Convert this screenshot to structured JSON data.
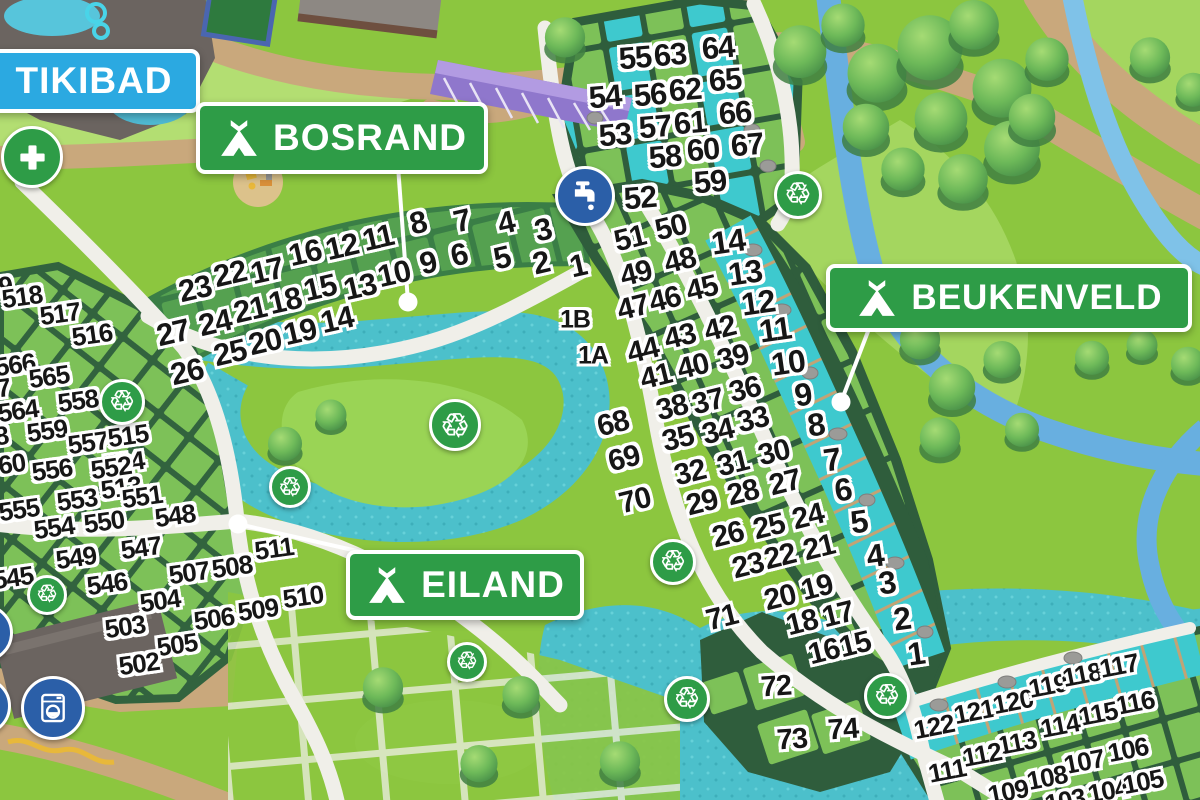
{
  "map": {
    "recycle_glyph": "♲",
    "colors": {
      "banner_green": "#2E9C47",
      "banner_blue": "#2BA9E1",
      "icon_blue": "#2B5FA8",
      "water_teal": "#4CC0CB",
      "stream_blue": "#68AFE0",
      "number_fill": "#161616",
      "number_outline": "#FFFFFF"
    },
    "banners": {
      "tikibad": {
        "label": "TIKIBAD"
      },
      "bosrand": {
        "label": "BOSRAND"
      },
      "beukenveld": {
        "label": "BEUKENVELD"
      },
      "eiland": {
        "label": "EILAND"
      }
    },
    "area_styles": {
      "A": {
        "size": 31,
        "rot": -5
      },
      "B": {
        "size": 30,
        "rot": -14
      },
      "C": {
        "size": 31,
        "rot": -13
      },
      "D": {
        "size": 32,
        "rot": -8
      },
      "E": {
        "size": 26,
        "rot": -8
      },
      "F": {
        "size": 26,
        "rot": -11
      },
      "G": {
        "size": 29,
        "rot": -4
      },
      "H": {
        "size": 25,
        "rot": 0
      }
    },
    "plot_labels": [
      [
        "55",
        635,
        58,
        "A"
      ],
      [
        "63",
        670,
        55,
        "A"
      ],
      [
        "64",
        718,
        48,
        "A"
      ],
      [
        "54",
        605,
        97,
        "A"
      ],
      [
        "56",
        650,
        95,
        "A"
      ],
      [
        "62",
        685,
        90,
        "A"
      ],
      [
        "65",
        725,
        80,
        "A"
      ],
      [
        "53",
        615,
        135,
        "A"
      ],
      [
        "57",
        655,
        127,
        "A"
      ],
      [
        "61",
        690,
        123,
        "A"
      ],
      [
        "66",
        735,
        113,
        "A"
      ],
      [
        "58",
        665,
        157,
        "A"
      ],
      [
        "60",
        703,
        150,
        "A"
      ],
      [
        "67",
        747,
        145,
        "A"
      ],
      [
        "59",
        710,
        182,
        "A"
      ],
      [
        "52",
        640,
        198,
        "A"
      ],
      [
        "51",
        630,
        239,
        "B"
      ],
      [
        "50",
        671,
        228,
        "B"
      ],
      [
        "49",
        636,
        274,
        "B"
      ],
      [
        "48",
        680,
        261,
        "B"
      ],
      [
        "47",
        633,
        308,
        "B"
      ],
      [
        "46",
        665,
        300,
        "B"
      ],
      [
        "45",
        702,
        289,
        "B"
      ],
      [
        "44",
        643,
        351,
        "B"
      ],
      [
        "43",
        680,
        337,
        "B"
      ],
      [
        "42",
        720,
        329,
        "B"
      ],
      [
        "41",
        656,
        377,
        "B"
      ],
      [
        "40",
        693,
        367,
        "B"
      ],
      [
        "39",
        733,
        358,
        "B"
      ],
      [
        "38",
        672,
        408,
        "B"
      ],
      [
        "37",
        708,
        402,
        "B"
      ],
      [
        "36",
        745,
        390,
        "B"
      ],
      [
        "35",
        678,
        439,
        "B"
      ],
      [
        "34",
        718,
        432,
        "B"
      ],
      [
        "33",
        753,
        420,
        "B"
      ],
      [
        "32",
        690,
        473,
        "B"
      ],
      [
        "31",
        733,
        464,
        "B"
      ],
      [
        "30",
        774,
        453,
        "B"
      ],
      [
        "29",
        702,
        503,
        "B"
      ],
      [
        "28",
        743,
        493,
        "B"
      ],
      [
        "27",
        785,
        483,
        "B"
      ],
      [
        "26",
        728,
        535,
        "B"
      ],
      [
        "25",
        769,
        527,
        "B"
      ],
      [
        "24",
        808,
        517,
        "B"
      ],
      [
        "23",
        748,
        566,
        "B"
      ],
      [
        "22",
        780,
        557,
        "B"
      ],
      [
        "21",
        819,
        548,
        "B"
      ],
      [
        "20",
        780,
        598,
        "B"
      ],
      [
        "19",
        817,
        588,
        "B"
      ],
      [
        "18",
        802,
        623,
        "B"
      ],
      [
        "17",
        838,
        615,
        "B"
      ],
      [
        "16",
        824,
        652,
        "B"
      ],
      [
        "15",
        855,
        645,
        "B"
      ],
      [
        "68",
        613,
        424,
        "B"
      ],
      [
        "69",
        624,
        459,
        "B"
      ],
      [
        "70",
        635,
        501,
        "B"
      ],
      [
        "71",
        722,
        618,
        "B"
      ],
      [
        "23",
        195,
        289,
        "C"
      ],
      [
        "22",
        230,
        274,
        "C"
      ],
      [
        "17",
        267,
        271,
        "C"
      ],
      [
        "16",
        305,
        253,
        "C"
      ],
      [
        "12",
        342,
        247,
        "C"
      ],
      [
        "11",
        378,
        238,
        "C"
      ],
      [
        "8",
        418,
        223,
        "C"
      ],
      [
        "7",
        462,
        221,
        "C"
      ],
      [
        "4",
        506,
        223,
        "C"
      ],
      [
        "3",
        543,
        230,
        "C"
      ],
      [
        "24",
        215,
        323,
        "C"
      ],
      [
        "21",
        250,
        310,
        "C"
      ],
      [
        "18",
        285,
        301,
        "C"
      ],
      [
        "15",
        320,
        288,
        "C"
      ],
      [
        "13",
        360,
        287,
        "C"
      ],
      [
        "10",
        394,
        274,
        "C"
      ],
      [
        "9",
        428,
        263,
        "C"
      ],
      [
        "6",
        459,
        255,
        "C"
      ],
      [
        "5",
        502,
        258,
        "C"
      ],
      [
        "2",
        541,
        263,
        "C"
      ],
      [
        "1",
        578,
        266,
        "C"
      ],
      [
        "27",
        173,
        333,
        "C"
      ],
      [
        "25",
        230,
        353,
        "C"
      ],
      [
        "20",
        265,
        342,
        "C"
      ],
      [
        "19",
        300,
        332,
        "C"
      ],
      [
        "14",
        337,
        320,
        "C"
      ],
      [
        "26",
        187,
        372,
        "C"
      ],
      [
        "14",
        728,
        242,
        "D"
      ],
      [
        "13",
        745,
        273,
        "D"
      ],
      [
        "12",
        758,
        303,
        "D"
      ],
      [
        "11",
        775,
        330,
        "D"
      ],
      [
        "10",
        788,
        363,
        "D"
      ],
      [
        "9",
        803,
        395,
        "D"
      ],
      [
        "8",
        816,
        425,
        "D"
      ],
      [
        "7",
        832,
        460,
        "D"
      ],
      [
        "6",
        843,
        490,
        "D"
      ],
      [
        "5",
        859,
        522,
        "D"
      ],
      [
        "4",
        875,
        556,
        "D"
      ],
      [
        "3",
        887,
        583,
        "D"
      ],
      [
        "2",
        902,
        619,
        "D"
      ],
      [
        "1",
        916,
        654,
        "D"
      ],
      [
        "72",
        776,
        687,
        "G"
      ],
      [
        "73",
        792,
        740,
        "G"
      ],
      [
        "74",
        843,
        730,
        "G"
      ],
      [
        "1B",
        575,
        320,
        "H"
      ],
      [
        "1A",
        593,
        356,
        "H"
      ],
      [
        "519",
        -8,
        288,
        "E"
      ],
      [
        "518",
        22,
        297,
        "E"
      ],
      [
        "517",
        60,
        314,
        "E"
      ],
      [
        "516",
        92,
        335,
        "E"
      ],
      [
        "566",
        15,
        365,
        "E"
      ],
      [
        "565",
        49,
        377,
        "E"
      ],
      [
        "558",
        78,
        401,
        "E"
      ],
      [
        "567",
        -10,
        390,
        "E"
      ],
      [
        "564",
        18,
        411,
        "E"
      ],
      [
        "559",
        47,
        431,
        "E"
      ],
      [
        "557",
        88,
        443,
        "E"
      ],
      [
        "515",
        128,
        436,
        "E"
      ],
      [
        "514",
        124,
        463,
        "E"
      ],
      [
        "513",
        121,
        488,
        "E"
      ],
      [
        "568",
        -12,
        438,
        "E"
      ],
      [
        "560",
        5,
        465,
        "E"
      ],
      [
        "556",
        52,
        470,
        "E"
      ],
      [
        "552",
        111,
        468,
        "E"
      ],
      [
        "555",
        19,
        510,
        "E"
      ],
      [
        "553",
        77,
        500,
        "E"
      ],
      [
        "551",
        142,
        497,
        "E"
      ],
      [
        "554",
        54,
        528,
        "E"
      ],
      [
        "550",
        104,
        522,
        "E"
      ],
      [
        "548",
        175,
        516,
        "E"
      ],
      [
        "547",
        141,
        548,
        "E"
      ],
      [
        "549",
        76,
        558,
        "E"
      ],
      [
        "545",
        13,
        578,
        "E"
      ],
      [
        "546",
        107,
        584,
        "E"
      ],
      [
        "511",
        274,
        549,
        "E"
      ],
      [
        "507",
        189,
        573,
        "E"
      ],
      [
        "508",
        232,
        567,
        "E"
      ],
      [
        "504",
        160,
        601,
        "E"
      ],
      [
        "510",
        303,
        597,
        "E"
      ],
      [
        "509",
        258,
        610,
        "E"
      ],
      [
        "506",
        214,
        619,
        "E"
      ],
      [
        "505",
        177,
        645,
        "E"
      ],
      [
        "503",
        125,
        627,
        "E"
      ],
      [
        "502",
        139,
        664,
        "E"
      ],
      [
        "122",
        934,
        727,
        "F"
      ],
      [
        "121",
        974,
        712,
        "F"
      ],
      [
        "120",
        1013,
        702,
        "F"
      ],
      [
        "119",
        1048,
        686,
        "F"
      ],
      [
        "118",
        1082,
        675,
        "F"
      ],
      [
        "117",
        1119,
        666,
        "F"
      ],
      [
        "116",
        1135,
        703,
        "F"
      ],
      [
        "115",
        1098,
        714,
        "F"
      ],
      [
        "114",
        1060,
        726,
        "F"
      ],
      [
        "113",
        1017,
        743,
        "F"
      ],
      [
        "112",
        982,
        755,
        "F"
      ],
      [
        "111",
        947,
        771,
        "F"
      ],
      [
        "106",
        1128,
        750,
        "F"
      ],
      [
        "107",
        1084,
        762,
        "F"
      ],
      [
        "108",
        1047,
        778,
        "F"
      ],
      [
        "109",
        1008,
        792,
        "F"
      ],
      [
        "104",
        1108,
        791,
        "F"
      ],
      [
        "105",
        1143,
        782,
        "F"
      ],
      [
        "103",
        1065,
        801,
        "F"
      ]
    ],
    "icons": [
      {
        "type": "first-aid",
        "x": 32,
        "y": 157,
        "d": 56
      },
      {
        "type": "water-tap",
        "x": 585,
        "y": 196,
        "d": 54
      },
      {
        "type": "laundry",
        "x": 53,
        "y": 708,
        "d": 58
      },
      {
        "type": "recycling",
        "x": 798,
        "y": 195,
        "d": 42
      },
      {
        "type": "recycling",
        "x": 122,
        "y": 402,
        "d": 40
      },
      {
        "type": "recycling",
        "x": 290,
        "y": 487,
        "d": 36
      },
      {
        "type": "recycling",
        "x": 455,
        "y": 425,
        "d": 46
      },
      {
        "type": "recycling",
        "x": 47,
        "y": 595,
        "d": 34
      },
      {
        "type": "recycling",
        "x": 673,
        "y": 562,
        "d": 40
      },
      {
        "type": "recycling",
        "x": 687,
        "y": 699,
        "d": 40
      },
      {
        "type": "recycling",
        "x": 887,
        "y": 696,
        "d": 40
      },
      {
        "type": "recycling",
        "x": 467,
        "y": 662,
        "d": 34
      },
      {
        "type": "facility",
        "x": -16,
        "y": 633,
        "d": 52
      },
      {
        "type": "facility",
        "x": -18,
        "y": 706,
        "d": 52
      }
    ],
    "pointers": [
      {
        "x1": 398,
        "y1": 166,
        "x2": 408,
        "y2": 302
      },
      {
        "x1": 872,
        "y1": 321,
        "x2": 841,
        "y2": 402
      },
      {
        "x1": 366,
        "y1": 553,
        "x2": 238,
        "y2": 524
      }
    ]
  }
}
